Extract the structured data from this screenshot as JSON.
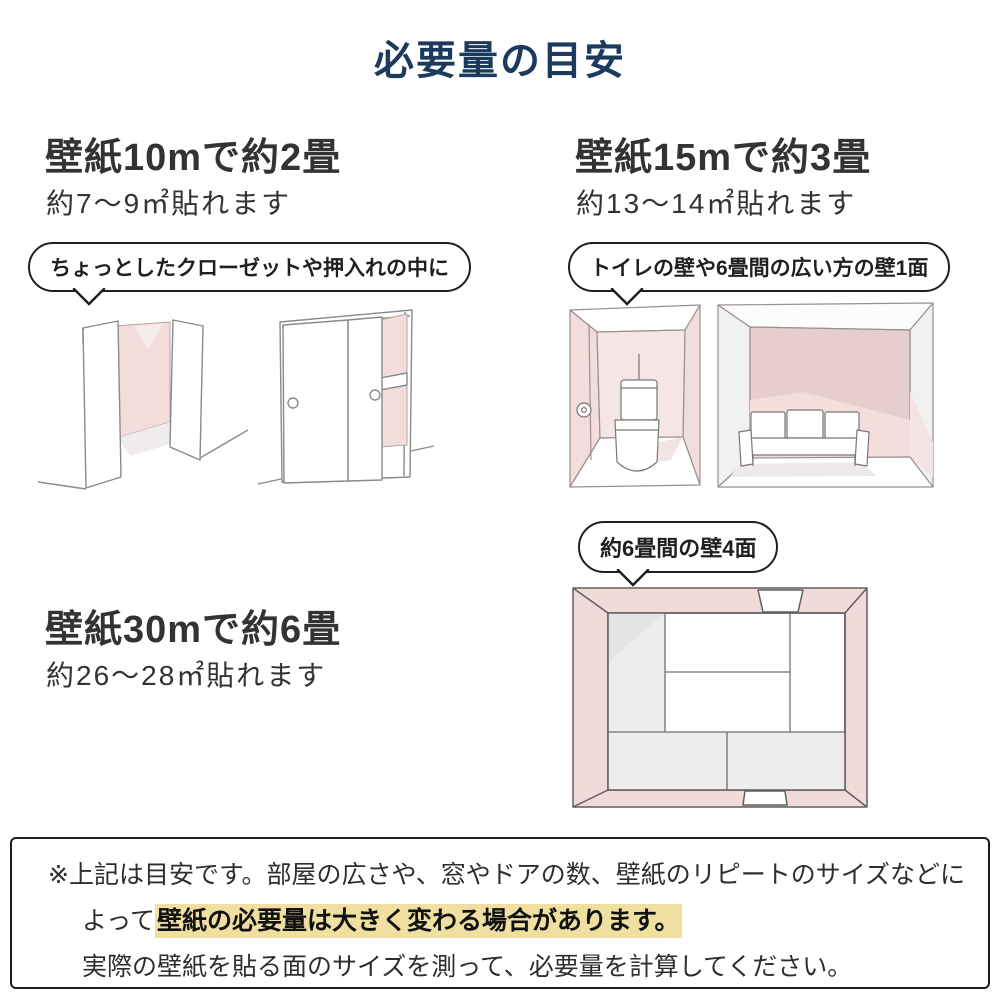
{
  "page": {
    "title": "必要量の目安"
  },
  "sections": [
    {
      "id": "wallpaper-10m",
      "heading": "壁紙10mで約2畳",
      "subheading": "約7〜9㎡貼れます",
      "bubble": "ちょっとしたクローゼットや押入れの中に"
    },
    {
      "id": "wallpaper-15m",
      "heading": "壁紙15mで約3畳",
      "subheading": "約13〜14㎡貼れます",
      "bubble": "トイレの壁や6畳間の広い方の壁1面"
    },
    {
      "id": "wallpaper-30m",
      "heading": "壁紙30mで約6畳",
      "subheading": "約26〜28㎡貼れます",
      "bubble": "約6畳間の壁4面"
    }
  ],
  "footer": {
    "line1": "※上記は目安です。部屋の広さや、窓やドアの数、壁紙のリピートのサイズなどに",
    "line2_prefix": "よって",
    "line2_highlight": "壁紙の必要量は大きく変わる場合があります。",
    "line3": "実際の壁紙を貼る面のサイズを測って、必要量を計算してください。"
  },
  "colors": {
    "title_navy": "#1b3a5e",
    "heading_gray": "#333333",
    "wall_pink": "#f2dcdc",
    "wall_pink_dark": "#e7cece",
    "wall_pink_light": "#f6e5e5",
    "shade_gray": "#ededed",
    "highlight_yellow": "#efe0a2",
    "sketch_line": "#8a8a8a"
  },
  "illustrations": {
    "closet_open": "open-closet-sketch",
    "closet_sliding": "sliding-door-closet-sketch",
    "toilet": "toilet-room-sketch",
    "living": "living-room-sofa-sketch",
    "room_top": "six-tatami-room-top-view-sketch"
  }
}
